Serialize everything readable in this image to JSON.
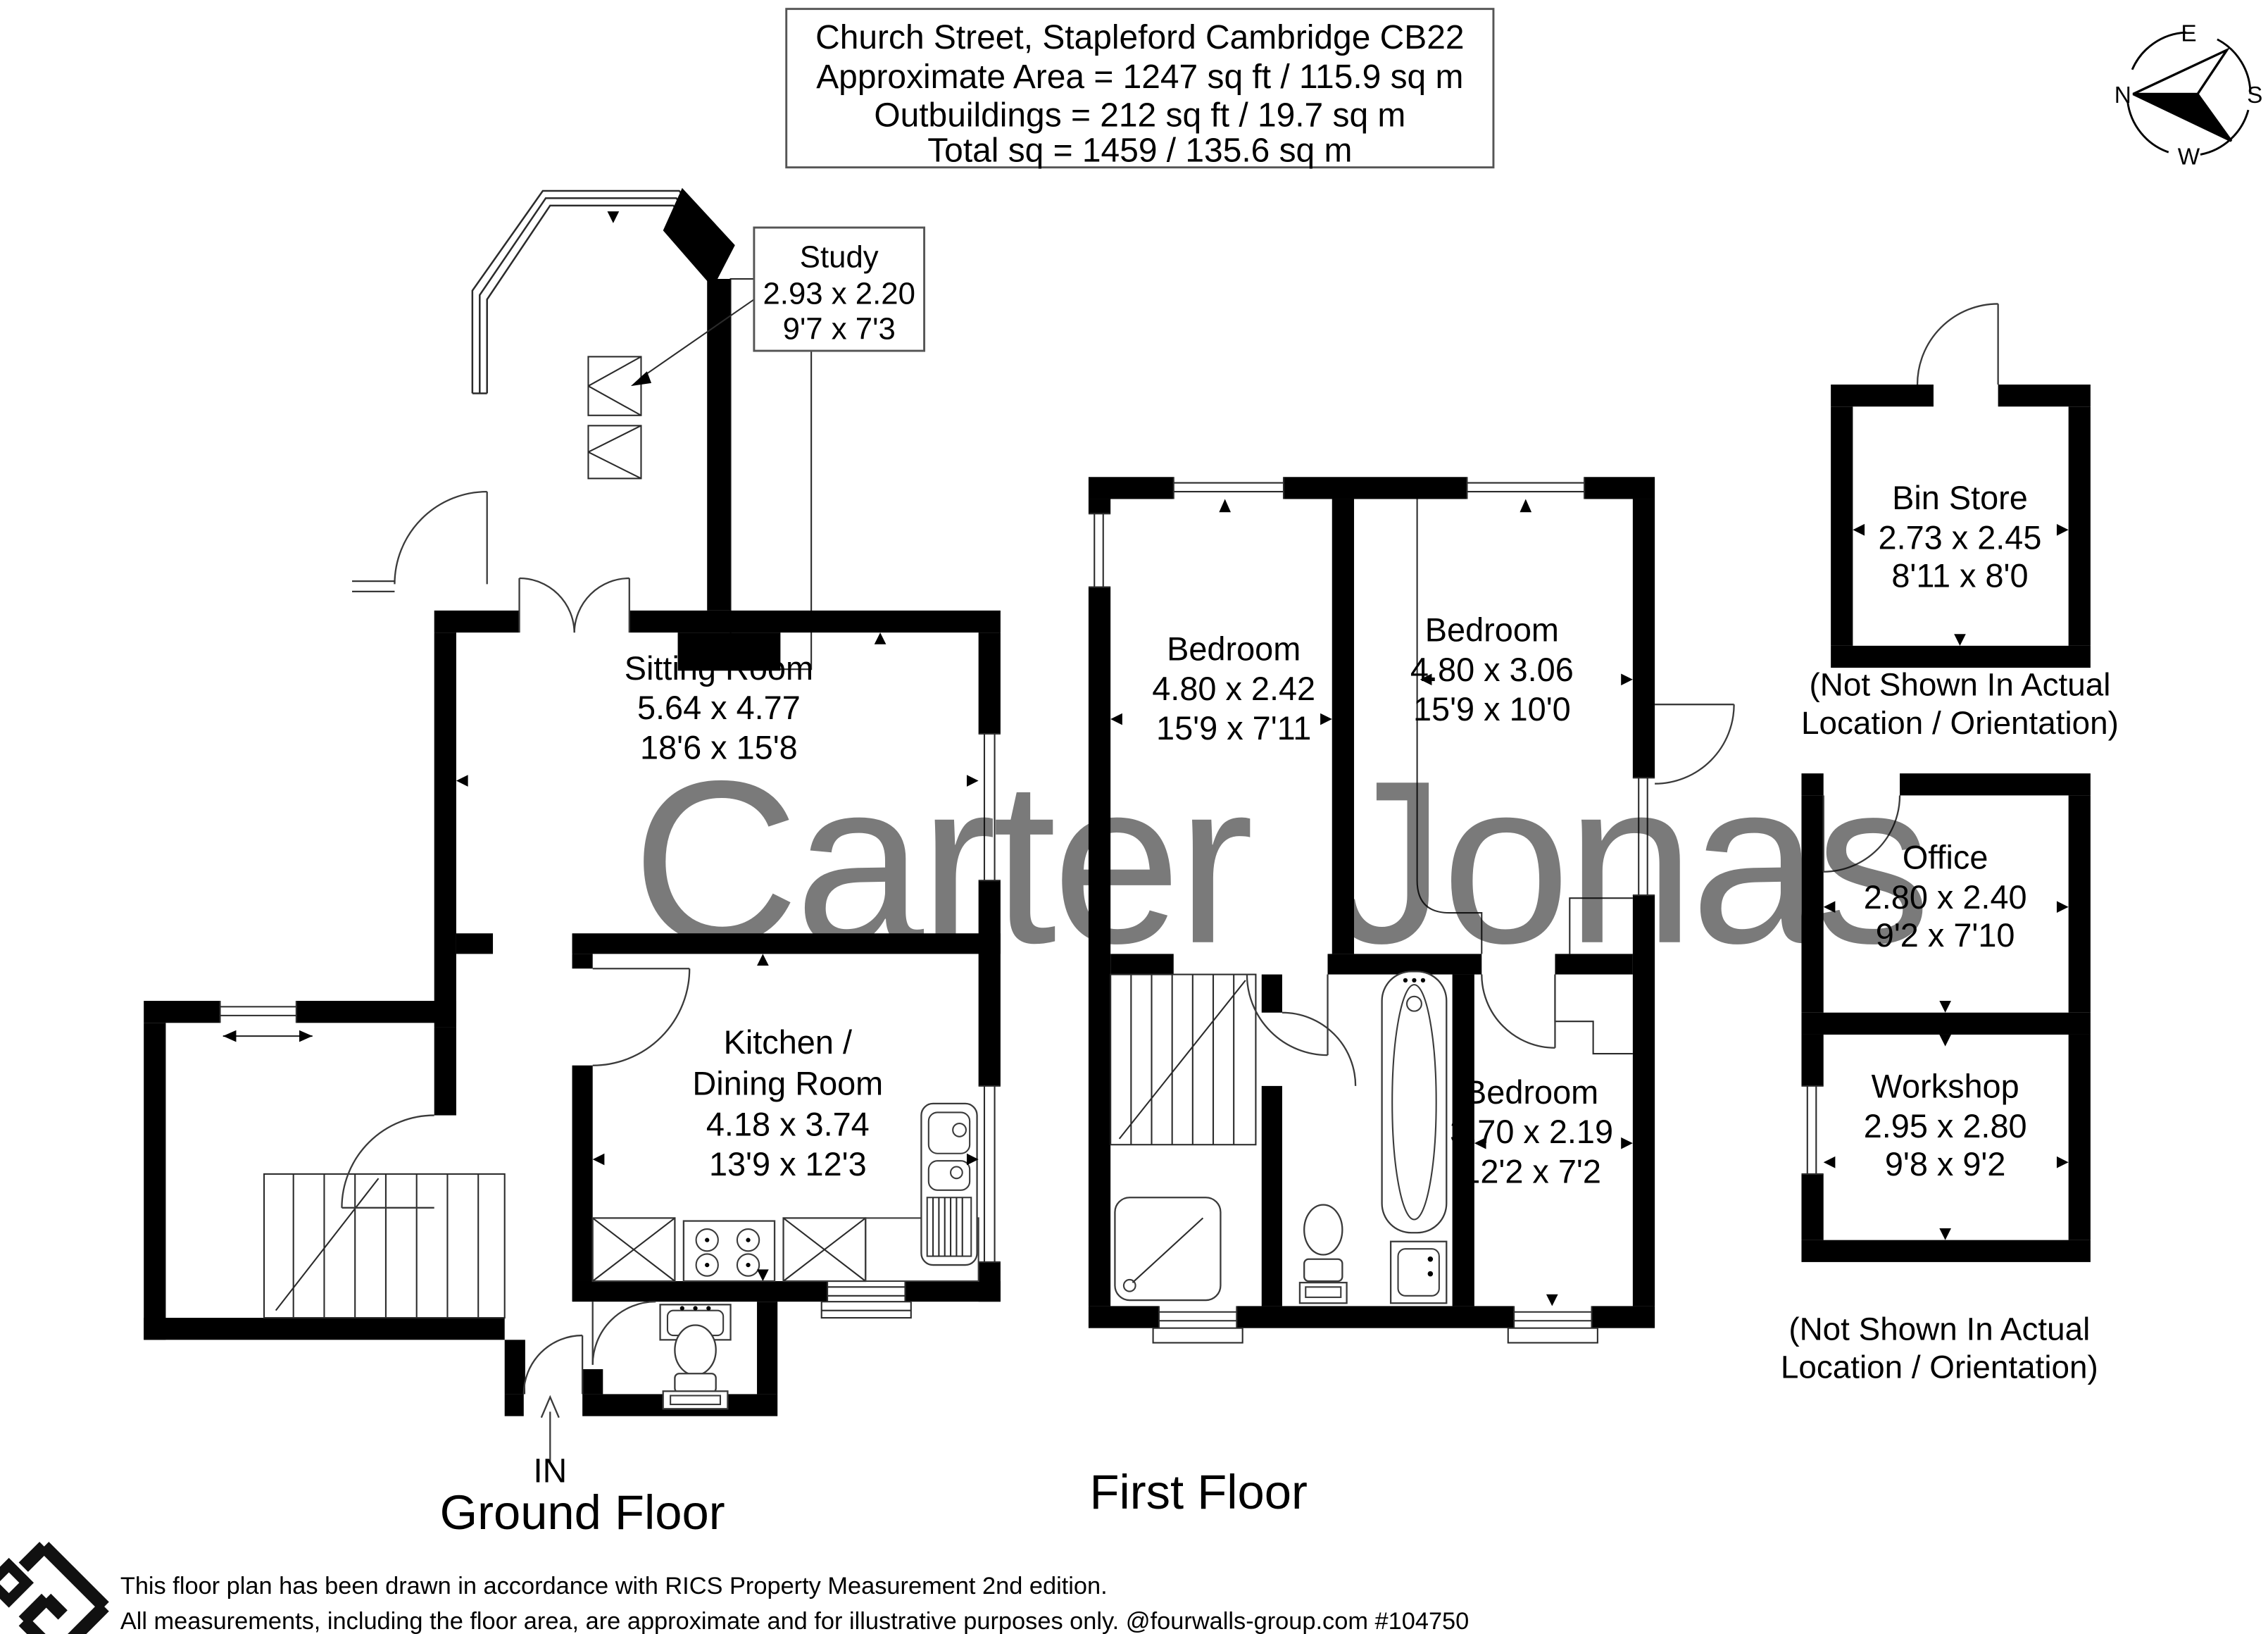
{
  "header": {
    "line1": "Church Street, Stapleford Cambridge CB22",
    "line2": "Approximate Area = 1247 sq ft / 115.9 sq m",
    "line3": "Outbuildings = 212 sq ft / 19.7 sq m",
    "line4": "Total sq = 1459 / 135.6 sq m"
  },
  "compass": {
    "n": "N",
    "e": "E",
    "s": "S",
    "w": "W"
  },
  "watermark": {
    "text": "Carter Jonas",
    "color": "#6e6288"
  },
  "rooms": {
    "study": {
      "name": "Study",
      "metric": "2.93 x 2.20",
      "imperial": "9'7 x 7'3"
    },
    "sitting": {
      "name": "Sitting Room",
      "metric": "5.64 x 4.77",
      "imperial": "18'6 x 15'8"
    },
    "kitchen": {
      "name1": "Kitchen /",
      "name2": "Dining Room",
      "metric": "4.18 x 3.74",
      "imperial": "13'9 x 12'3"
    },
    "bedroom1": {
      "name": "Bedroom",
      "metric": "4.80 x 2.42",
      "imperial": "15'9 x 7'11"
    },
    "bedroom2": {
      "name": "Bedroom",
      "metric": "4.80 x 3.06",
      "imperial": "15'9 x 10'0"
    },
    "bedroom3": {
      "name": "Bedroom",
      "metric": "3.70 x 2.19",
      "imperial": "12'2 x 7'2"
    },
    "bin_store": {
      "name": "Bin Store",
      "metric": "2.73 x 2.45",
      "imperial": "8'11 x 8'0"
    },
    "office": {
      "name": "Office",
      "metric": "2.80 x 2.40",
      "imperial": "9'2 x 7'10"
    },
    "workshop": {
      "name": "Workshop",
      "metric": "2.95 x 2.80",
      "imperial": "9'8 x 9'2"
    }
  },
  "notes": {
    "line1": "(Not Shown In Actual",
    "line2": "Location / Orientation)"
  },
  "entry": {
    "label": "IN"
  },
  "floors": {
    "ground": "Ground Floor",
    "first": "First Floor"
  },
  "footer": {
    "line1": "This floor plan has been drawn in accordance with RICS Property Measurement 2nd edition.",
    "line2": "All measurements, including the floor area, are approximate and for illustrative purposes only. @fourwalls-group.com #104750"
  }
}
